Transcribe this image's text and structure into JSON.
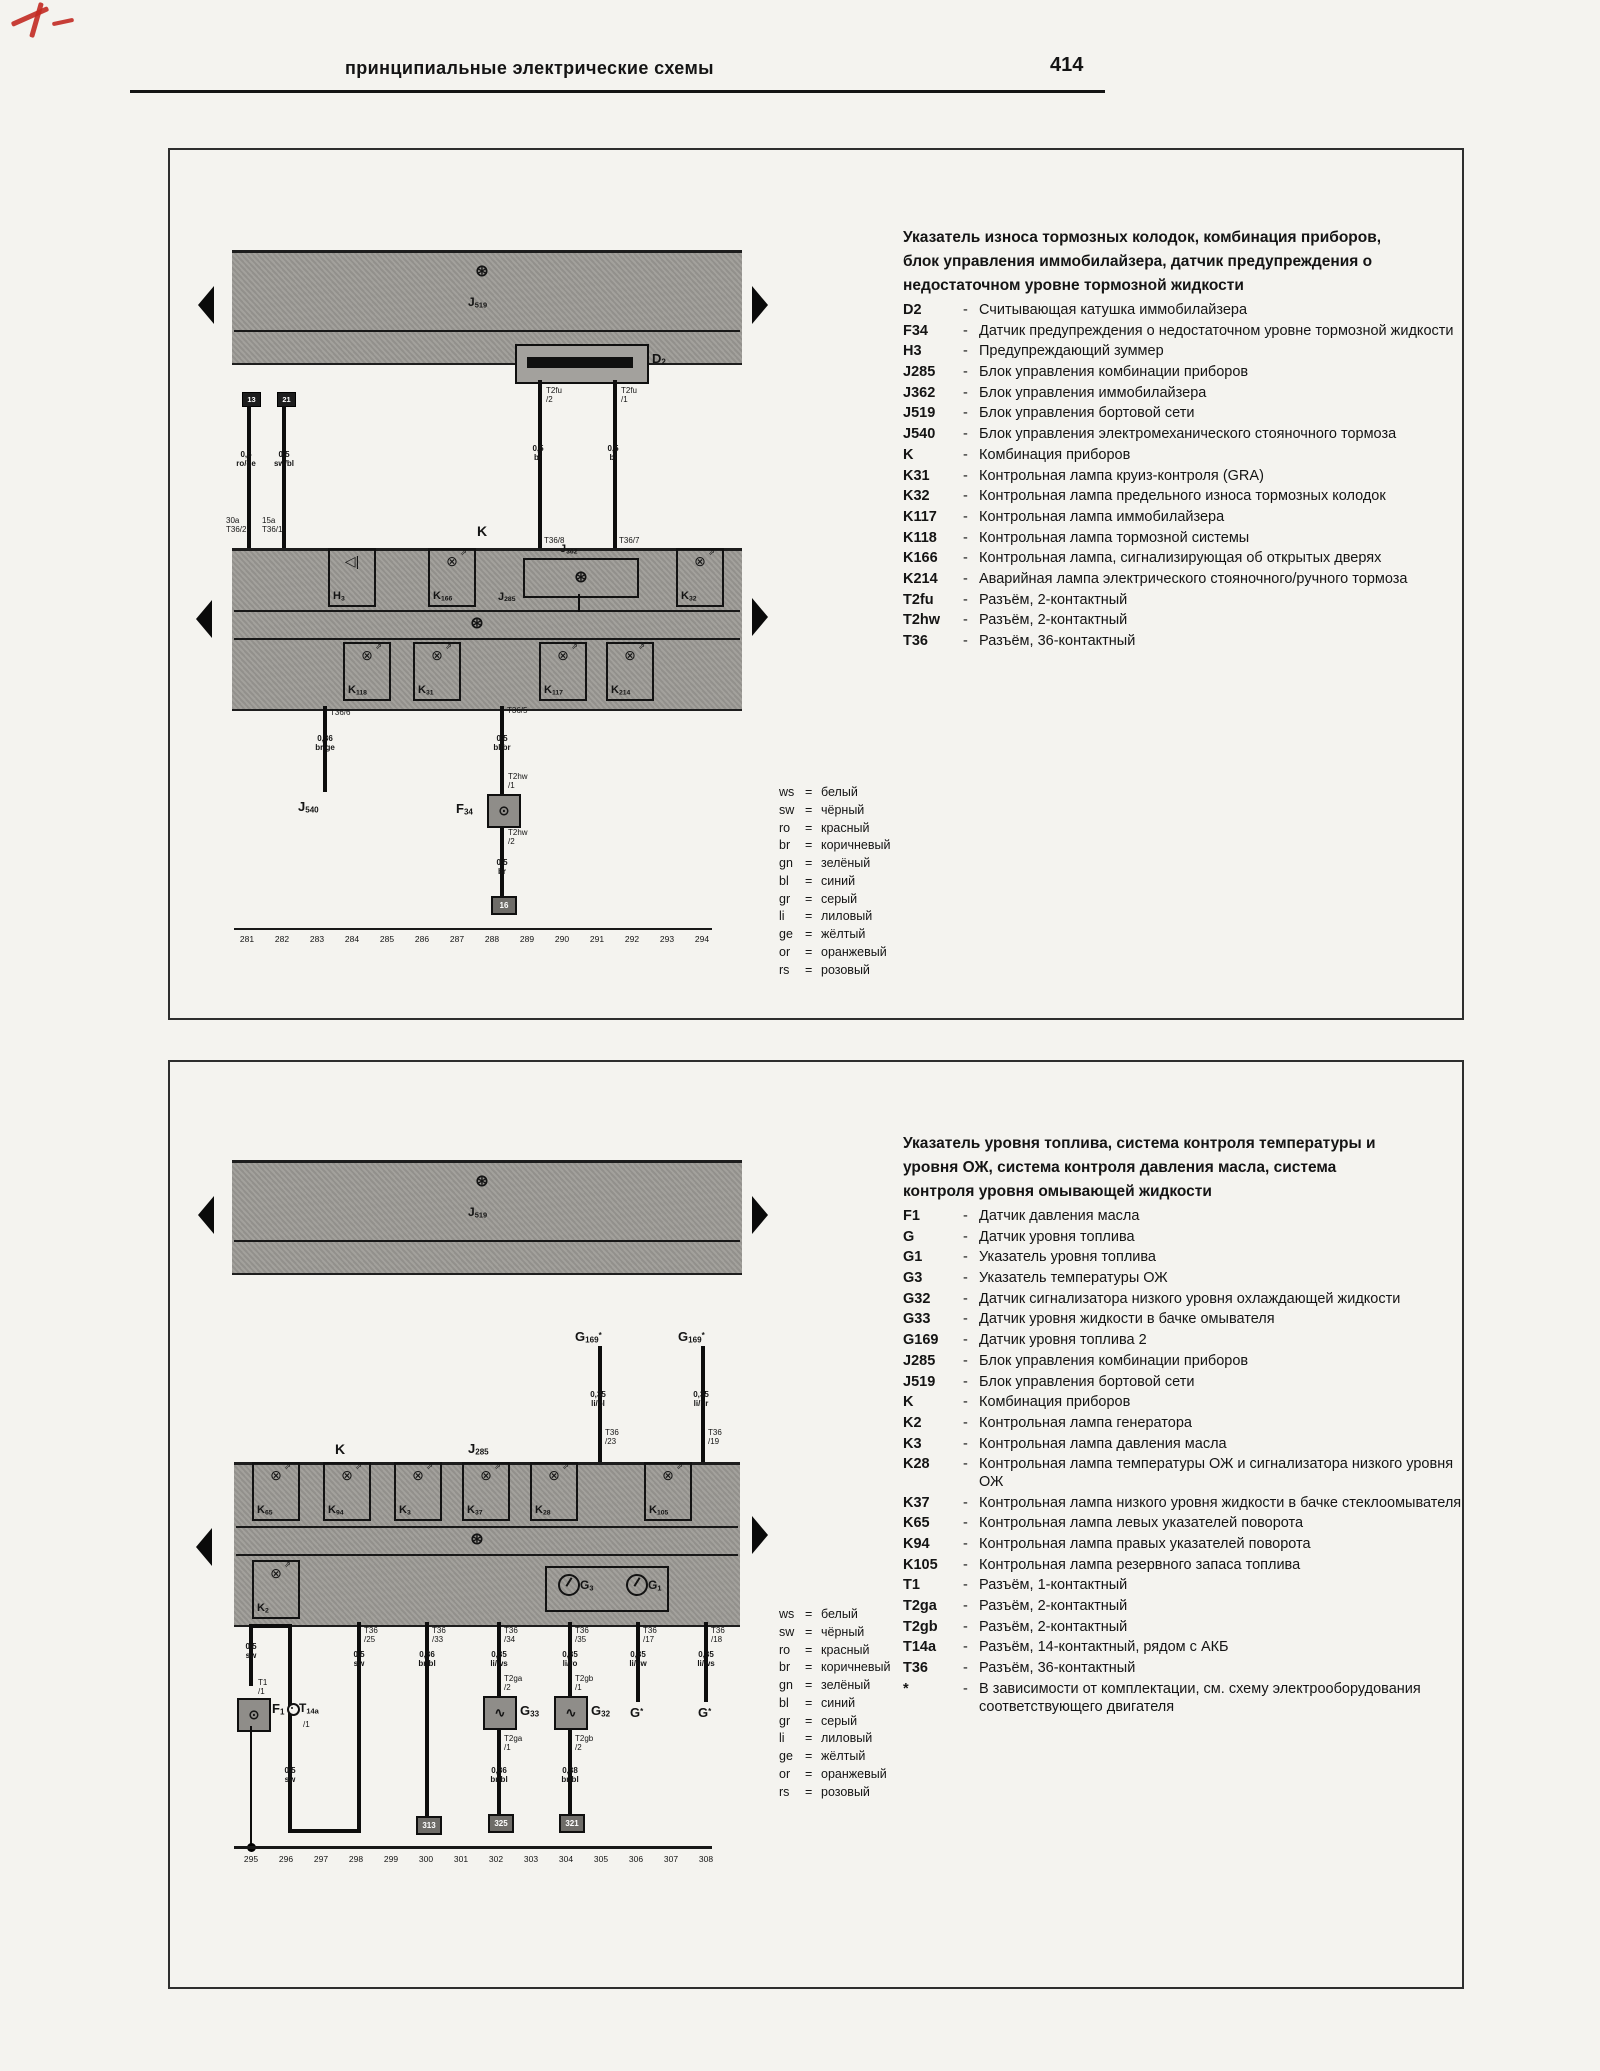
{
  "page": {
    "header_title": "принципиальные электрические схемы",
    "page_number": "414"
  },
  "color_code": [
    {
      "code": "ws",
      "name": "белый"
    },
    {
      "code": "sw",
      "name": "чёрный"
    },
    {
      "code": "ro",
      "name": "красный"
    },
    {
      "code": "br",
      "name": "коричневый"
    },
    {
      "code": "gn",
      "name": "зелёный"
    },
    {
      "code": "bl",
      "name": "синий"
    },
    {
      "code": "gr",
      "name": "серый"
    },
    {
      "code": "li",
      "name": "лиловый"
    },
    {
      "code": "ge",
      "name": "жёлтый"
    },
    {
      "code": "or",
      "name": "оранжевый"
    },
    {
      "code": "rs",
      "name": "розовый"
    }
  ],
  "panel1": {
    "title": "Указатель износа тормозных колодок, комбинация приборов,\nблок управления иммобилайзера, датчик предупреждения о\nнедостаточном уровне тормозной жидкости",
    "legend": [
      {
        "id": "D2",
        "desc": "Считывающая катушка иммобилайзера"
      },
      {
        "id": "F34",
        "desc": "Датчик предупреждения о недостаточном уровне тормозной жидкости"
      },
      {
        "id": "H3",
        "desc": "Предупреждающий зуммер"
      },
      {
        "id": "J285",
        "desc": "Блок управления комбинации приборов"
      },
      {
        "id": "J362",
        "desc": "Блок управления иммобилайзера"
      },
      {
        "id": "J519",
        "desc": "Блок управления бортовой сети"
      },
      {
        "id": "J540",
        "desc": "Блок управления электромеханического стояночного тормоза"
      },
      {
        "id": "K",
        "desc": "Комбинация приборов"
      },
      {
        "id": "K31",
        "desc": "Контрольная лампа круиз-контроля (GRA)"
      },
      {
        "id": "K32",
        "desc": "Контрольная лампа предельного износа тормозных колодок"
      },
      {
        "id": "K117",
        "desc": "Контрольная лампа иммобилайзера"
      },
      {
        "id": "K118",
        "desc": "Контрольная лампа тормозной системы"
      },
      {
        "id": "K166",
        "desc": "Контрольная лампа, сигнализирующая об открытых дверях"
      },
      {
        "id": "K214",
        "desc": "Аварийная лампа электрического стояночного/ручного тормоза"
      },
      {
        "id": "T2fu",
        "desc": "Разъём, 2-контактный"
      },
      {
        "id": "T2hw",
        "desc": "Разъём, 2-контактный"
      },
      {
        "id": "T36",
        "desc": "Разъём, 36-контактный"
      }
    ],
    "labels": {
      "j519": "J519",
      "k": "K",
      "j285": "J285",
      "j362": "J362",
      "d2": "D2",
      "f34": "F34",
      "j540": "J540",
      "conn1": "13",
      "conn2": "21",
      "w1size": "0,5\nro/ge",
      "w1pin": "30a\nT36/2",
      "w2size": "0,5\nsw/bl",
      "w2pin": "15a\nT36/1",
      "d2lpin": "T2fu\n/2",
      "d2rpin": "T2fu\n/1",
      "d2lsize": "0,5\nbr",
      "d2rsize": "0,5\nbl",
      "d2lk": "T36/8",
      "d2rk": "T36/7",
      "e1pin": "T36/6",
      "e1size": "0,36\nbr/ge",
      "e2pin": "T36/5",
      "e2size": "0,5\nbl/br",
      "t2hw1": "T2hw\n/1",
      "t2hw2": "T2hw\n/2",
      "e2size2": "0,5\nbr",
      "gnd": "16"
    },
    "lamps_top": [
      {
        "id": "H3",
        "x": 350,
        "type": "buzzer"
      },
      {
        "id": "K166",
        "x": 450
      },
      {
        "id": "J362",
        "x": 579,
        "type": "ecu"
      },
      {
        "id": "K32",
        "x": 698
      }
    ],
    "lamps_bottom": [
      {
        "id": "K118",
        "x": 365
      },
      {
        "id": "K31",
        "x": 435
      },
      {
        "id": "K117",
        "x": 561
      },
      {
        "id": "K214",
        "x": 628
      }
    ],
    "tracks": [
      "281",
      "282",
      "283",
      "284",
      "285",
      "286",
      "287",
      "288",
      "289",
      "290",
      "291",
      "292",
      "293",
      "294"
    ]
  },
  "panel2": {
    "title": "Указатель уровня топлива, система контроля температуры и\nуровня ОЖ, система контроля давления масла, система\nконтроля уровня омывающей жидкости",
    "legend": [
      {
        "id": "F1",
        "desc": "Датчик давления масла"
      },
      {
        "id": "G",
        "desc": "Датчик уровня топлива"
      },
      {
        "id": "G1",
        "desc": "Указатель уровня топлива"
      },
      {
        "id": "G3",
        "desc": "Указатель температуры ОЖ"
      },
      {
        "id": "G32",
        "desc": "Датчик сигнализатора низкого уровня охлаждающей жидкости"
      },
      {
        "id": "G33",
        "desc": "Датчик уровня жидкости в бачке омывателя"
      },
      {
        "id": "G169",
        "desc": "Датчик уровня топлива 2"
      },
      {
        "id": "J285",
        "desc": "Блок управления комбинации приборов"
      },
      {
        "id": "J519",
        "desc": "Блок управления бортовой сети"
      },
      {
        "id": "K",
        "desc": "Комбинация приборов"
      },
      {
        "id": "K2",
        "desc": "Контрольная лампа генератора"
      },
      {
        "id": "K3",
        "desc": "Контрольная лампа давления масла"
      },
      {
        "id": "K28",
        "desc": "Контрольная лампа температуры ОЖ и сигнализатора низкого уровня ОЖ"
      },
      {
        "id": "K37",
        "desc": "Контрольная лампа низкого уровня жидкости в бачке стеклоомывателя"
      },
      {
        "id": "K65",
        "desc": "Контрольная лампа левых указателей поворота"
      },
      {
        "id": "K94",
        "desc": "Контрольная лампа правых указателей поворота"
      },
      {
        "id": "K105",
        "desc": "Контрольная лампа резервного запаса топлива"
      },
      {
        "id": "T1",
        "desc": "Разъём, 1-контактный"
      },
      {
        "id": "T2ga",
        "desc": "Разъём, 2-контактный"
      },
      {
        "id": "T2gb",
        "desc": "Разъём, 2-контактный"
      },
      {
        "id": "T14a",
        "desc": "Разъём, 14-контактный, рядом с АКБ"
      },
      {
        "id": "T36",
        "desc": "Разъём, 36-контактный"
      },
      {
        "id": "*",
        "desc": "В зависимости от комплектации, см. схему электрооборудования соответствующего двигателя"
      }
    ],
    "labels": {
      "j519": "J519",
      "k": "K",
      "j285": "J285",
      "g169a": "G169*",
      "g169b": "G169*",
      "wg169a": "0,35\nli/bl",
      "wg169b": "0,35\nli/br",
      "pg169a": "T36\n/23",
      "pg169b": "T36\n/19",
      "pb1": "T36\n/25",
      "pb2": "T36\n/33",
      "pb3": "T36\n/34",
      "pb4": "T36\n/35",
      "pb5": "T36\n/17",
      "pb6": "T36\n/18",
      "sb1": "0,5\nsw",
      "sb2": "0,36\nbr/bl",
      "sb3": "0,35\nli/ws",
      "sb4": "0,35\nli/ro",
      "sb5": "0,35\nli/sw",
      "sb6": "0,35\nli/ws",
      "f1": "F1",
      "f1size": "0,5\nsw",
      "f1size2": "0,5\nsw",
      "t1": "T1\n/1",
      "t14a": "T14a",
      "t14apin": "/1",
      "g33": "G33",
      "g32": "G32",
      "cg33a": "T2ga\n/2",
      "cg33b": "T2ga\n/1",
      "sg33": "0,36\nbr/bl",
      "cg32a": "T2gb\n/1",
      "cg32b": "T2gb\n/2",
      "sg32": "0,38\nbr/bl",
      "gnd1": "313",
      "gnd2": "325",
      "gnd3": "321",
      "gstar1": "G*",
      "gstar2": "G*"
    },
    "lamps_top": [
      {
        "id": "K65",
        "x": 274
      },
      {
        "id": "K94",
        "x": 345
      },
      {
        "id": "K3",
        "x": 416
      },
      {
        "id": "K37",
        "x": 484
      },
      {
        "id": "K28",
        "x": 552
      },
      {
        "id": "K105",
        "x": 666
      }
    ],
    "lamps_row2": [
      {
        "id": "K2",
        "x": 274
      }
    ],
    "gauges": [
      {
        "id": "G3",
        "x": 567
      },
      {
        "id": "G1",
        "x": 635
      }
    ],
    "tracks": [
      "295",
      "296",
      "297",
      "298",
      "299",
      "300",
      "301",
      "302",
      "303",
      "304",
      "305",
      "306",
      "307",
      "308"
    ]
  }
}
